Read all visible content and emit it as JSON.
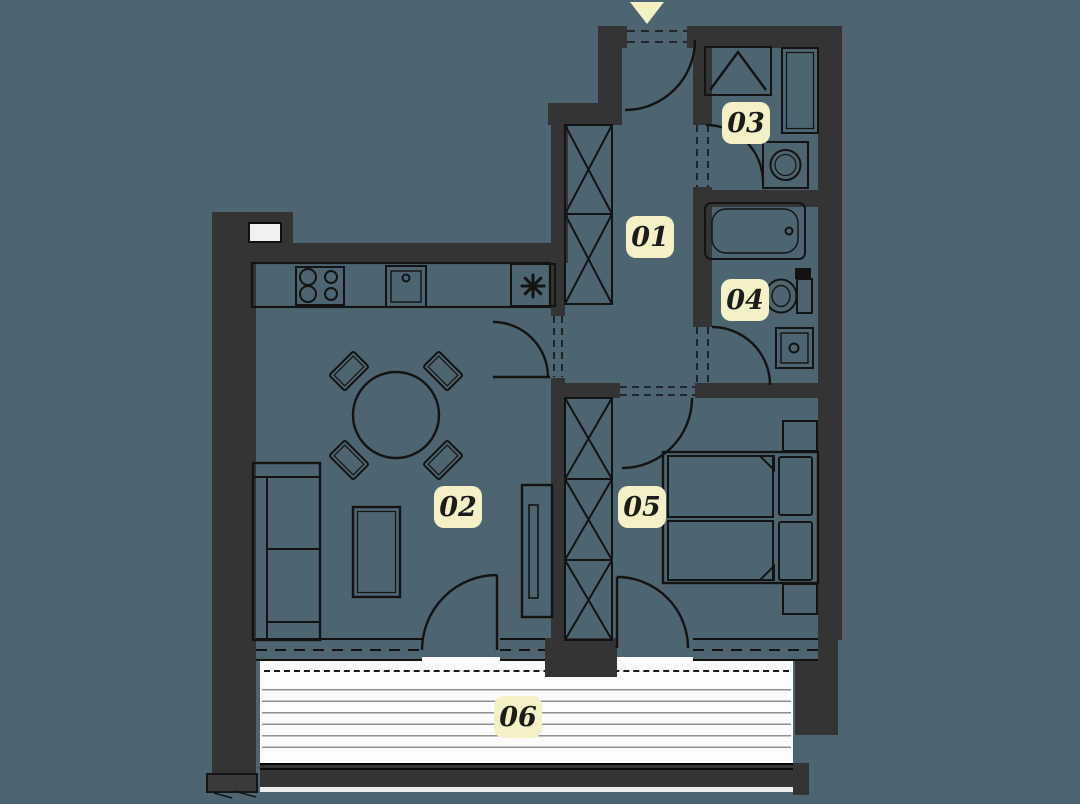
{
  "plan": {
    "rooms": [
      {
        "label": "01"
      },
      {
        "label": "02"
      },
      {
        "label": "03"
      },
      {
        "label": "04"
      },
      {
        "label": "05"
      },
      {
        "label": "06"
      }
    ],
    "colors": {
      "background": "#4d6570",
      "walls": "#343434",
      "linework": "#131313",
      "balcony_floor": "#fbfbfb",
      "label_background": "#f6f0c6",
      "label_text": "#1c1c1c",
      "entrance_marker": "#f5efc6"
    },
    "entrance_marker": "down-triangle"
  }
}
